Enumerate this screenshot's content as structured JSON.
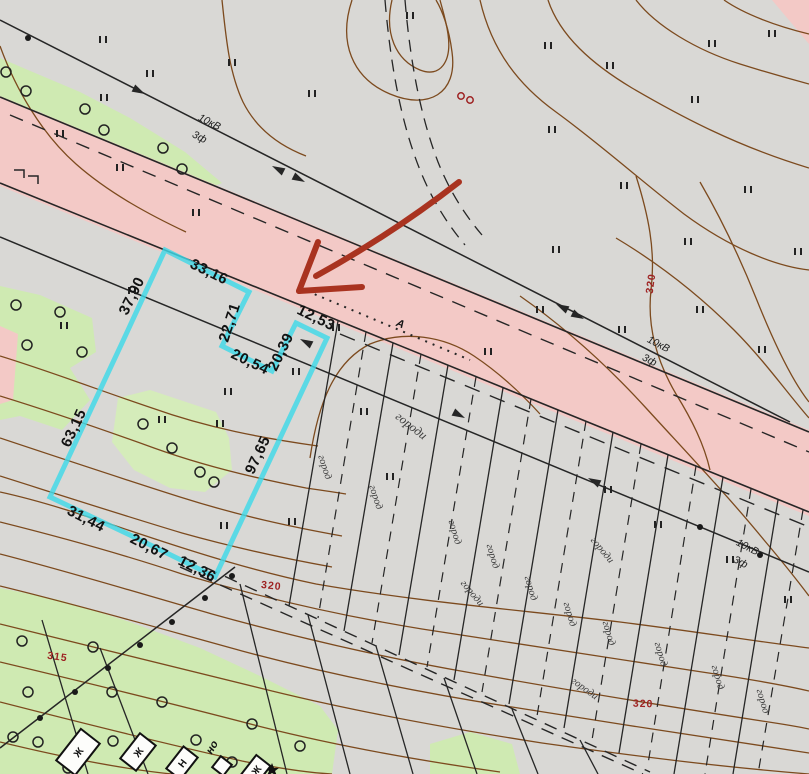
{
  "map": {
    "colors": {
      "background": "#d9d8d5",
      "road_pink": "#f3c9c6",
      "vegetation_green": "#cfeab2",
      "highlight_cyan": "#3fd9e8",
      "contour_brown": "#7c4a1e",
      "elevation_red": "#9e2222",
      "arrow_red": "#a93320",
      "line_black": "#262626"
    },
    "dimension_labels": [
      {
        "text": "33,16",
        "x": 207,
        "y": 276,
        "rot": 26
      },
      {
        "text": "37,90",
        "x": 136,
        "y": 298,
        "rot": -64
      },
      {
        "text": "22,71",
        "x": 234,
        "y": 324,
        "rot": -72
      },
      {
        "text": "20,54",
        "x": 248,
        "y": 366,
        "rot": 26
      },
      {
        "text": "20,39",
        "x": 285,
        "y": 354,
        "rot": -64
      },
      {
        "text": "12,53",
        "x": 314,
        "y": 322,
        "rot": 26
      },
      {
        "text": "97,65",
        "x": 262,
        "y": 457,
        "rot": -65
      },
      {
        "text": "63,15",
        "x": 78,
        "y": 430,
        "rot": -65
      },
      {
        "text": "31,44",
        "x": 84,
        "y": 523,
        "rot": 27
      },
      {
        "text": "20,67",
        "x": 147,
        "y": 551,
        "rot": 27
      },
      {
        "text": "12,36",
        "x": 195,
        "y": 573,
        "rot": 27
      }
    ],
    "powerline_labels": [
      {
        "text": "10кВ",
        "x": 208,
        "y": 125,
        "rot": 27
      },
      {
        "text": "3ф",
        "x": 198,
        "y": 140,
        "rot": 27
      },
      {
        "text": "10кВ",
        "x": 657,
        "y": 347,
        "rot": 27
      },
      {
        "text": "3ф",
        "x": 648,
        "y": 363,
        "rot": 27
      },
      {
        "text": "10кВ",
        "x": 746,
        "y": 550,
        "rot": 27
      },
      {
        "text": "3ф",
        "x": 739,
        "y": 565,
        "rot": 27
      }
    ],
    "elevation_labels": [
      {
        "text": "320",
        "x": 654,
        "y": 284,
        "rot": -82
      },
      {
        "text": "320",
        "x": 271,
        "y": 589,
        "rot": 6
      },
      {
        "text": "320",
        "x": 643,
        "y": 707,
        "rot": 2
      },
      {
        "text": "315",
        "x": 57,
        "y": 660,
        "rot": 8
      }
    ],
    "garden_labels": [
      {
        "text": "городи",
        "x": 409,
        "y": 429,
        "rot": 38,
        "size": 12.5
      },
      {
        "text": "город",
        "x": 322,
        "y": 468,
        "rot": 72
      },
      {
        "text": "город",
        "x": 373,
        "y": 498,
        "rot": 72
      },
      {
        "text": "город",
        "x": 452,
        "y": 533,
        "rot": 74
      },
      {
        "text": "город",
        "x": 490,
        "y": 557,
        "rot": 74
      },
      {
        "text": "городи",
        "x": 600,
        "y": 552,
        "rot": 50
      },
      {
        "text": "городи",
        "x": 470,
        "y": 595,
        "rot": 50
      },
      {
        "text": "город",
        "x": 528,
        "y": 589,
        "rot": 74
      },
      {
        "text": "город",
        "x": 567,
        "y": 615,
        "rot": 74
      },
      {
        "text": "город",
        "x": 606,
        "y": 634,
        "rot": 74
      },
      {
        "text": "город",
        "x": 658,
        "y": 655,
        "rot": 74
      },
      {
        "text": "городи",
        "x": 583,
        "y": 691,
        "rot": 36
      },
      {
        "text": "город",
        "x": 715,
        "y": 678,
        "rot": 74
      },
      {
        "text": "город",
        "x": 760,
        "y": 702,
        "rot": 74
      }
    ],
    "road_label": {
      "text": "А",
      "x": 399,
      "y": 327,
      "rot": 22
    },
    "misc_labels": [
      {
        "text": "но",
        "x": 215,
        "y": 749,
        "rot": -60
      }
    ],
    "grass_marks": [
      [
        103,
        40
      ],
      [
        150,
        74
      ],
      [
        232,
        63
      ],
      [
        312,
        94
      ],
      [
        410,
        16
      ],
      [
        548,
        46
      ],
      [
        610,
        66
      ],
      [
        712,
        44
      ],
      [
        772,
        34
      ],
      [
        695,
        100
      ],
      [
        552,
        130
      ],
      [
        624,
        186
      ],
      [
        688,
        242
      ],
      [
        748,
        190
      ],
      [
        798,
        252
      ],
      [
        120,
        168
      ],
      [
        196,
        213
      ],
      [
        132,
        291
      ],
      [
        64,
        326
      ],
      [
        162,
        420
      ],
      [
        220,
        424
      ],
      [
        296,
        372
      ],
      [
        224,
        526
      ],
      [
        292,
        522
      ],
      [
        390,
        477
      ],
      [
        488,
        352
      ],
      [
        540,
        310
      ],
      [
        622,
        330
      ],
      [
        700,
        310
      ],
      [
        762,
        350
      ],
      [
        556,
        250
      ],
      [
        608,
        490
      ],
      [
        658,
        525
      ],
      [
        730,
        560
      ],
      [
        788,
        600
      ],
      [
        364,
        412
      ],
      [
        336,
        328
      ],
      [
        228,
        392
      ],
      [
        104,
        98
      ],
      [
        60,
        134
      ]
    ],
    "tree_circles": [
      [
        6,
        72
      ],
      [
        26,
        91
      ],
      [
        85,
        109
      ],
      [
        104,
        130
      ],
      [
        163,
        148
      ],
      [
        182,
        169
      ],
      [
        16,
        305
      ],
      [
        27,
        345
      ],
      [
        82,
        352
      ],
      [
        60,
        312
      ],
      [
        143,
        424
      ],
      [
        172,
        448
      ],
      [
        200,
        472
      ],
      [
        214,
        482
      ],
      [
        22,
        641
      ],
      [
        93,
        647
      ],
      [
        28,
        692
      ],
      [
        112,
        692
      ],
      [
        13,
        737
      ],
      [
        38,
        742
      ],
      [
        113,
        741
      ],
      [
        196,
        740
      ],
      [
        68,
        768
      ],
      [
        232,
        762
      ],
      [
        162,
        702
      ],
      [
        252,
        724
      ],
      [
        300,
        746
      ]
    ],
    "pole_dots": [
      [
        28,
        38
      ],
      [
        40,
        718
      ],
      [
        75,
        692
      ],
      [
        108,
        668
      ],
      [
        140,
        645
      ],
      [
        172,
        622
      ],
      [
        205,
        598
      ],
      [
        232,
        576
      ],
      [
        700,
        527
      ],
      [
        760,
        555
      ]
    ],
    "buildings": [
      {
        "x": 78,
        "y": 752,
        "w": 24,
        "h": 40,
        "rot": 38,
        "label": "Ж"
      },
      {
        "x": 138,
        "y": 752,
        "w": 20,
        "h": 32,
        "rot": 38,
        "label": "Ж"
      },
      {
        "x": 182,
        "y": 763,
        "w": 18,
        "h": 28,
        "rot": 38,
        "label": "Н"
      },
      {
        "x": 222,
        "y": 766,
        "w": 14,
        "h": 14,
        "rot": 38,
        "label": ""
      },
      {
        "x": 256,
        "y": 770,
        "w": 18,
        "h": 24,
        "rot": 38,
        "label": "Ж"
      }
    ]
  }
}
